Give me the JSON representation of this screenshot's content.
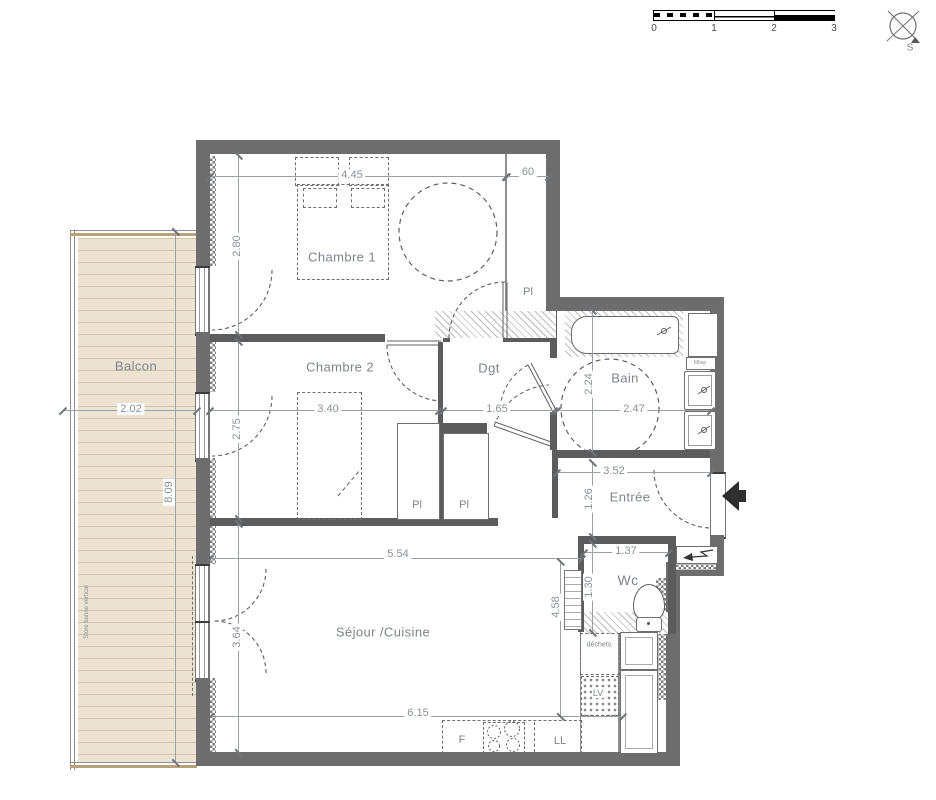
{
  "scalebar": {
    "ticks": [
      "0",
      "1",
      "2",
      "3"
    ]
  },
  "compass": {
    "south": "S"
  },
  "rooms": {
    "balcon": "Balcon",
    "chambre1": "Chambre 1",
    "chambre2": "Chambre 2",
    "dgt": "Dgt",
    "bain": "Bain",
    "entree": "Entrée",
    "wc": "Wc",
    "sejour": "Séjour /Cuisine"
  },
  "labels": {
    "pl": "Pl",
    "dechets": "déchets",
    "lv": "LV",
    "ll": "LL",
    "f": "F",
    "mbsp": "Mbsp",
    "vr": "VR",
    "store": "Store banne vertical"
  },
  "dims": {
    "ch1_w": "4.45",
    "closet_w": "60",
    "ch1_h": "2.80",
    "ch2_w": "3.40",
    "ch2_h": "2.75",
    "dgt_w": "1.65",
    "bain_w": "2.47",
    "bain_h": "2.24",
    "balcon_w": "2.02",
    "balcon_h": "8.09",
    "entree_w": "3.52",
    "entree_h": "1.26",
    "wc_w": "1.37",
    "wc_h": "1.30",
    "sejour_w": "5.54",
    "sejour_w2": "6.15",
    "sejour_h": "3.64",
    "kitchen_h": "4.58"
  },
  "colors": {
    "wall": "#6d6d6d",
    "deck": "#ece3d2",
    "label": "#7e838e"
  }
}
